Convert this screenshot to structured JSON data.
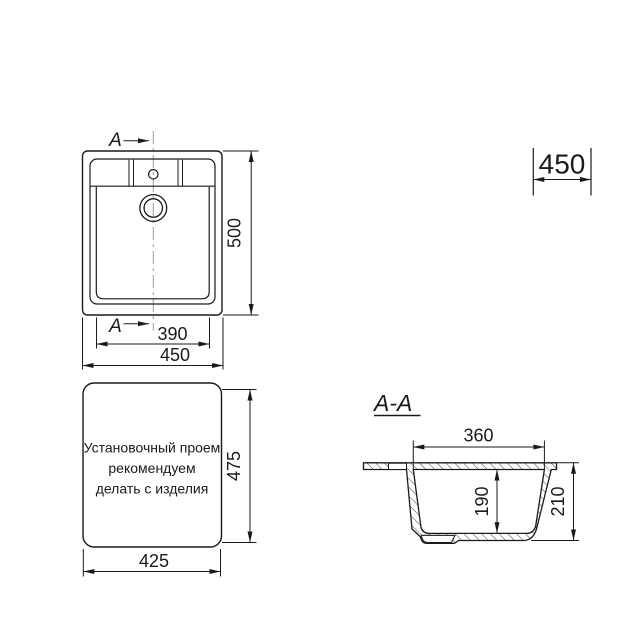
{
  "colors": {
    "line": "#1a1a1a",
    "centerline": "#9c9c9c",
    "background": "#ffffff"
  },
  "top_view": {
    "section_label_top": "A",
    "section_label_bottom": "A",
    "dim_height": "500",
    "dim_bowl_width": "390",
    "dim_width": "450"
  },
  "cabinet_dim": {
    "value": "450"
  },
  "cutout": {
    "note_lines": [
      "Установочный проем",
      "рекомендуем",
      "делать с изделия"
    ],
    "dim_height": "475",
    "dim_width": "425"
  },
  "section_view": {
    "title": "A-A",
    "dim_opening_width": "360",
    "dim_depth": "190",
    "dim_height": "210"
  }
}
